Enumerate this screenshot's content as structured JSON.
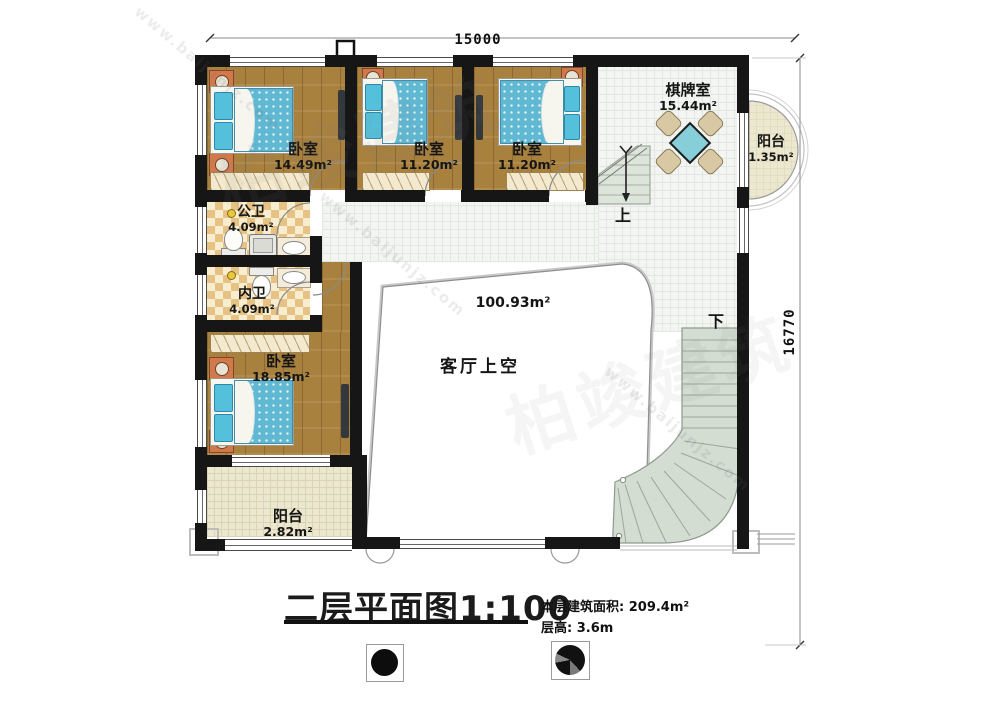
{
  "watermark": {
    "cn": "柏竣建筑",
    "url": "www.baijunjz.com"
  },
  "dimensions": {
    "top": "15000",
    "right": "16770"
  },
  "rooms": {
    "bedroom1": {
      "name": "卧室",
      "area": "14.49m²"
    },
    "bedroom2": {
      "name": "卧室",
      "area": "11.20m²"
    },
    "bedroom3": {
      "name": "卧室",
      "area": "11.20m²"
    },
    "chess": {
      "name": "棋牌室",
      "area": "15.44m²"
    },
    "balcony_right": {
      "name": "阳台",
      "area": "1.35m²"
    },
    "bath_public": {
      "name": "公卫",
      "area": "4.09m²"
    },
    "bath_private": {
      "name": "内卫",
      "area": "4.09m²"
    },
    "bedroom4": {
      "name": "卧室",
      "area": "18.85m²"
    },
    "balcony_bottom": {
      "name": "阳台",
      "area": "2.82m²"
    },
    "living_void": {
      "name": "客厅上空",
      "area": "100.93m²"
    }
  },
  "stairs": {
    "up": "上",
    "down": "下"
  },
  "footer": {
    "title": "二层平面图",
    "scale": "1:100",
    "floor_area": "本层建筑面积: 209.4m²",
    "floor_height": "层高: 3.6m"
  }
}
